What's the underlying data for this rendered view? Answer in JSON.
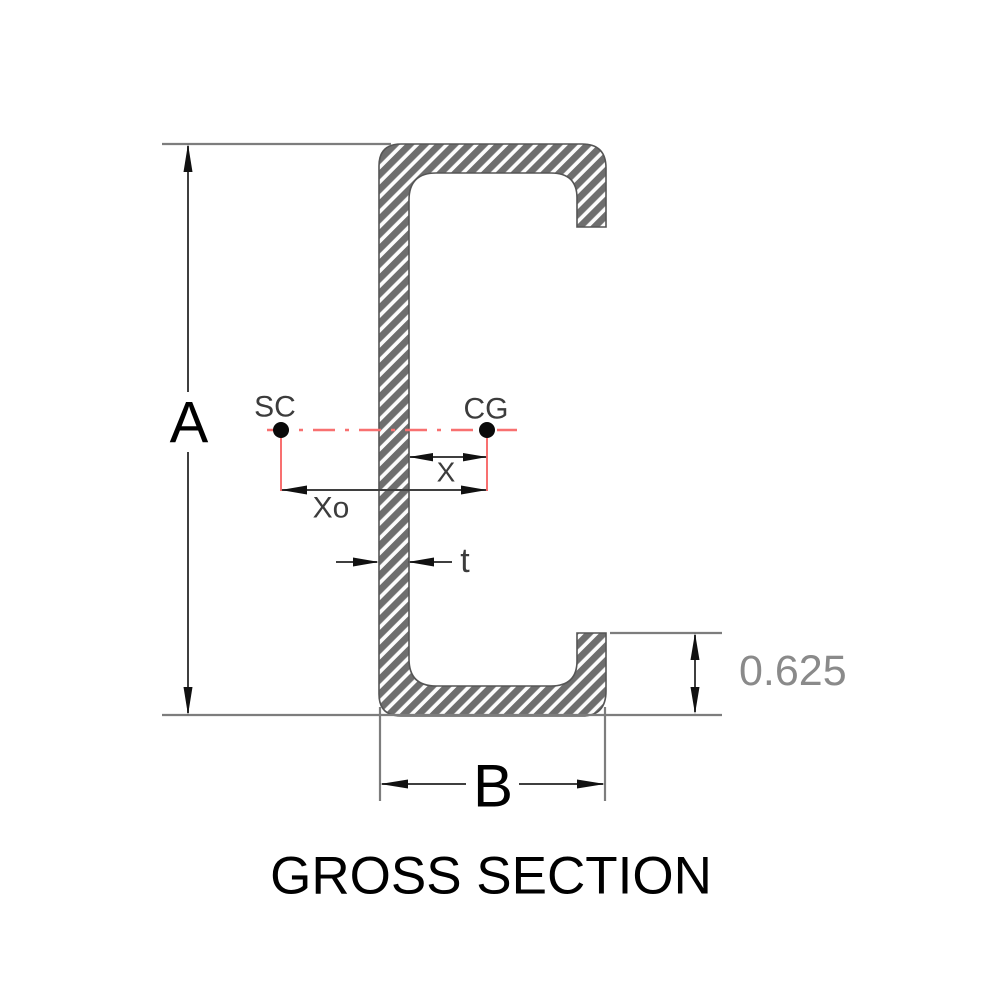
{
  "title": "GROSS SECTION",
  "labels": {
    "depth": "A",
    "flange_width": "B",
    "thickness": "t",
    "cg_offset": "X",
    "sc_offset": "Xo",
    "lip_length": "0.625",
    "shear_center": "SC",
    "center_of_gravity": "CG"
  },
  "colors": {
    "hatch_dark": "#6e6e6e",
    "hatch_light": "#fdfdfd",
    "section_outline": "#555555",
    "extension_line_gray": "#7d7d7d",
    "dimension_line_dark": "#3f3f3f",
    "arrow_black": "#111111",
    "centerline_red": "#f87070",
    "lip_dim_text_gray": "#8a8a8a",
    "small_label_gray": "#3c3c3c",
    "text_black": "#000000"
  }
}
